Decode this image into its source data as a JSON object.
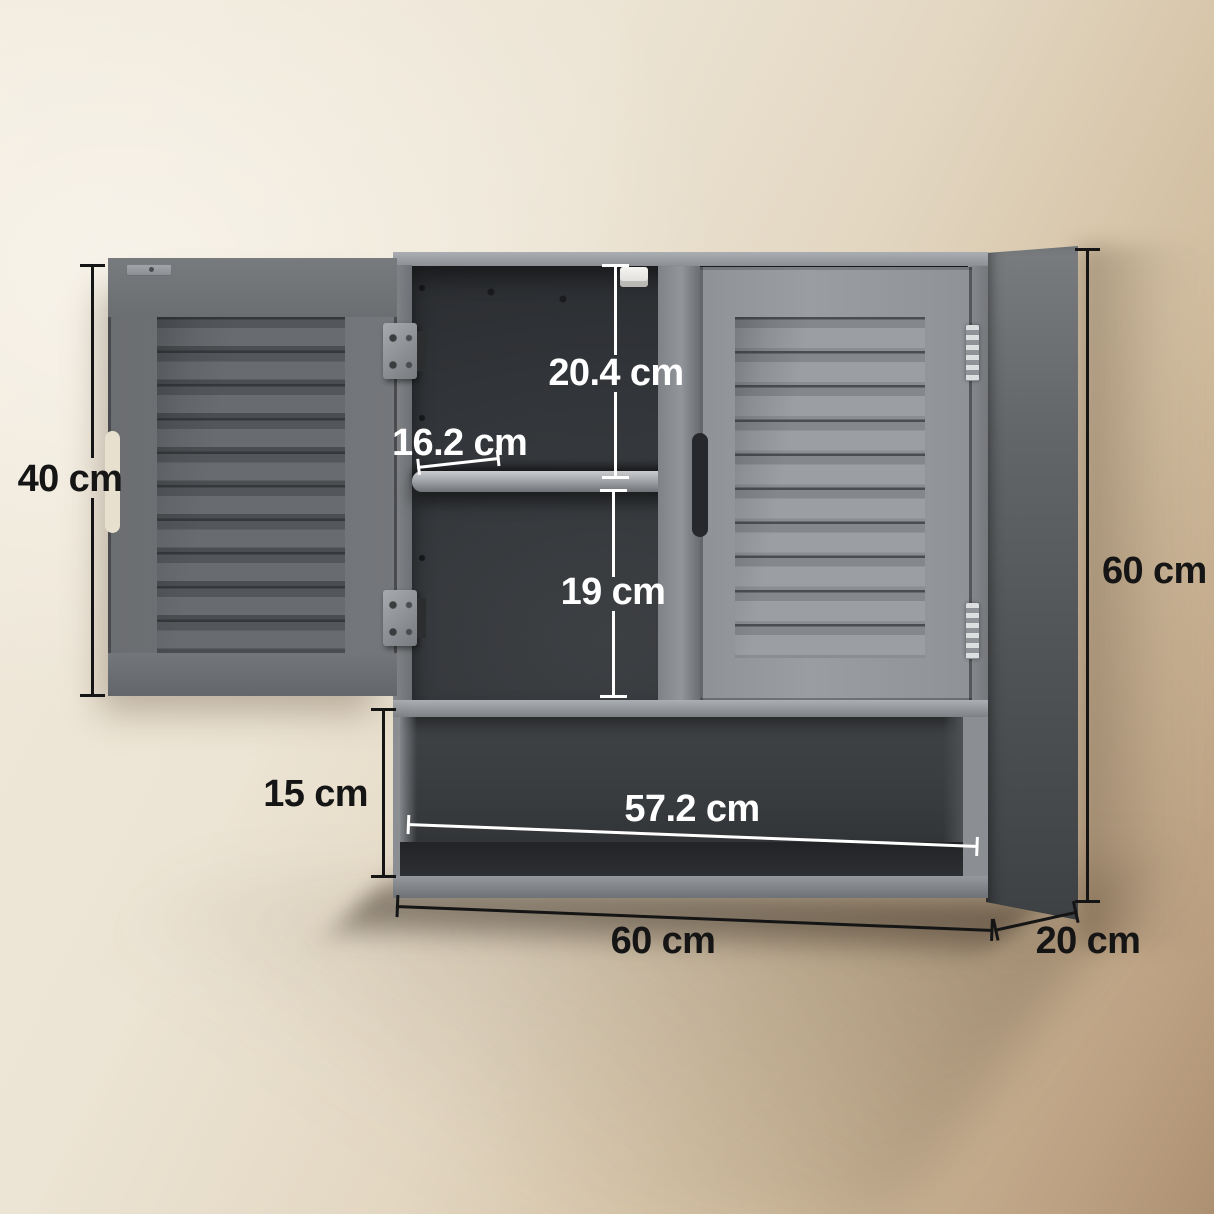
{
  "diagram": {
    "type": "product-dimension-diagram",
    "product_name": "Grey wall-mounted two-door louvered bathroom cabinet with open shelf",
    "measurements": {
      "door_height": "40 cm",
      "top_compartment_height": "20.4 cm",
      "shelf_depth": "16.2 cm",
      "middle_compartment_height": "19 cm",
      "open_shelf_height": "15 cm",
      "inner_width": "57.2 cm",
      "overall_width": "60 cm",
      "overall_depth": "20 cm",
      "overall_height": "60 cm"
    },
    "colors": {
      "wall_light": "#efe8da",
      "wall_dark": "#ac9071",
      "cabinet_grey": "#8b8e92",
      "door_front_grey": "#9a9da1",
      "door_open_grey": "#6b6e72",
      "interior_dark": "#303336",
      "annotation_black": "#151515",
      "annotation_white": "#ffffff"
    }
  }
}
